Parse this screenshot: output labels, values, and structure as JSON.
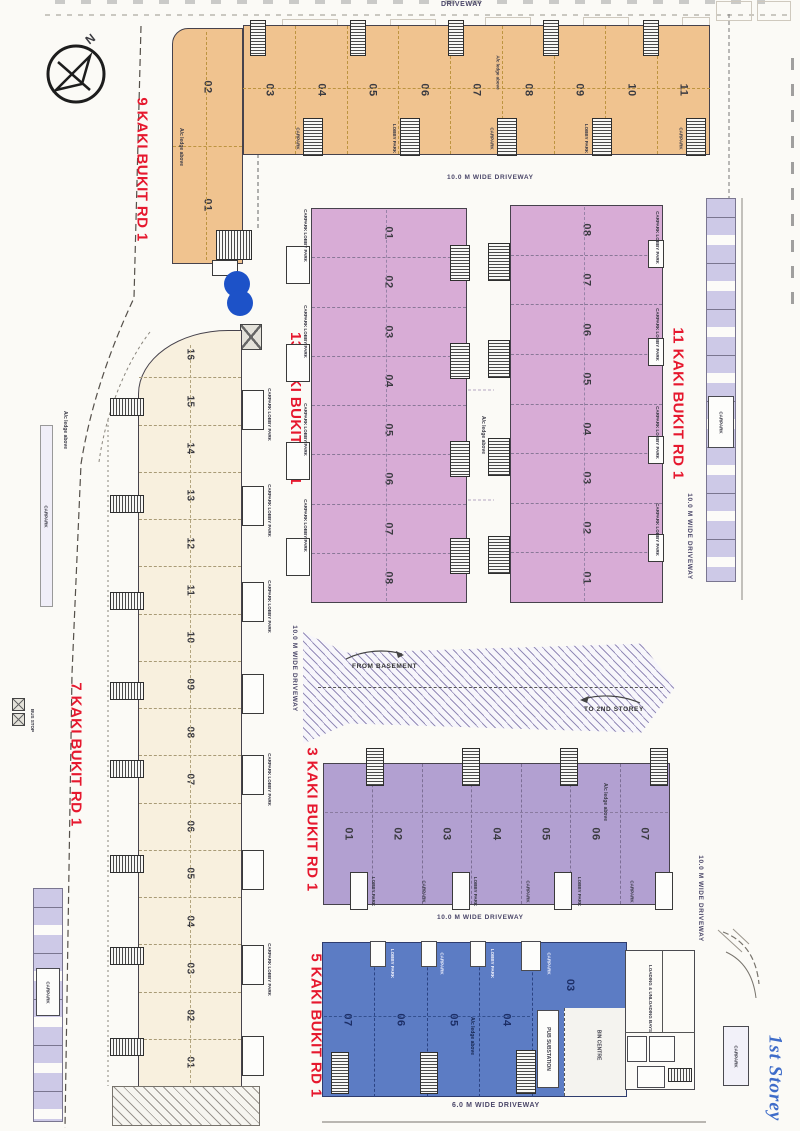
{
  "document": {
    "storey_note": "1st Storey",
    "compass": "N"
  },
  "roads": {
    "driveway": "DRIVEWAY",
    "wide_driveway_10m": "10.0 M WIDE DRIVEWAY",
    "wide_driveway_6m": "6.0 M WIDE DRIVEWAY"
  },
  "ramp": {
    "from_basement": "FROM BASEMENT",
    "to_2nd_storey": "TO 2ND STOREY"
  },
  "labels": {
    "carpark": "CARPARK",
    "lobby_park": "LOBBY PARK",
    "carpark_lobby": "CARPARK LOBBY PARK",
    "bus_stop": "BUS STOP",
    "ac_ledge": "A/c ledge above",
    "pub_substation": "PUB SUBSTATION",
    "bin_centre": "BIN CENTRE",
    "loading_bays": "LOADING & UNLOADING BAYS"
  },
  "blocks": {
    "b9": {
      "name": "9 KAKI BUKIT RD 1",
      "units_wing": [
        "02",
        "01"
      ],
      "units_row": [
        "03",
        "04",
        "05",
        "06",
        "07",
        "08",
        "09",
        "10",
        "11"
      ]
    },
    "b13": {
      "name": "13 KAKI BUKIT RD 1",
      "units": [
        "01",
        "02",
        "03",
        "04",
        "05",
        "06",
        "07",
        "08"
      ]
    },
    "b11": {
      "name": "11 KAKI BUKIT RD 1",
      "units": [
        "08",
        "07",
        "06",
        "05",
        "04",
        "03",
        "02",
        "01"
      ]
    },
    "b7": {
      "name": "7 KAKI BUKIT RD 1",
      "units": [
        "16",
        "15",
        "14",
        "13",
        "12",
        "11",
        "10",
        "09",
        "08",
        "07",
        "06",
        "05",
        "04",
        "03",
        "02",
        "01"
      ]
    },
    "b3": {
      "name": "3 KAKI BUKIT RD 1",
      "units": [
        "01",
        "02",
        "03",
        "04",
        "05",
        "06",
        "07"
      ]
    },
    "b5": {
      "name": "5 KAKI BUKIT RD 1",
      "units": [
        "07",
        "06",
        "05",
        "04"
      ],
      "unit_corner": "03"
    }
  },
  "colors": {
    "block9": "#f0c38f",
    "block13": "#d8acd6",
    "block11": "#d8acd6",
    "block7": "#f8f0de",
    "block3": "#b2a0d1",
    "block5": "#5c7cc4",
    "road_label": "#e6182e",
    "marker": "#1d52c8",
    "handwriting": "#3e6cc9",
    "carpark_stall": "#cdc9e7"
  }
}
